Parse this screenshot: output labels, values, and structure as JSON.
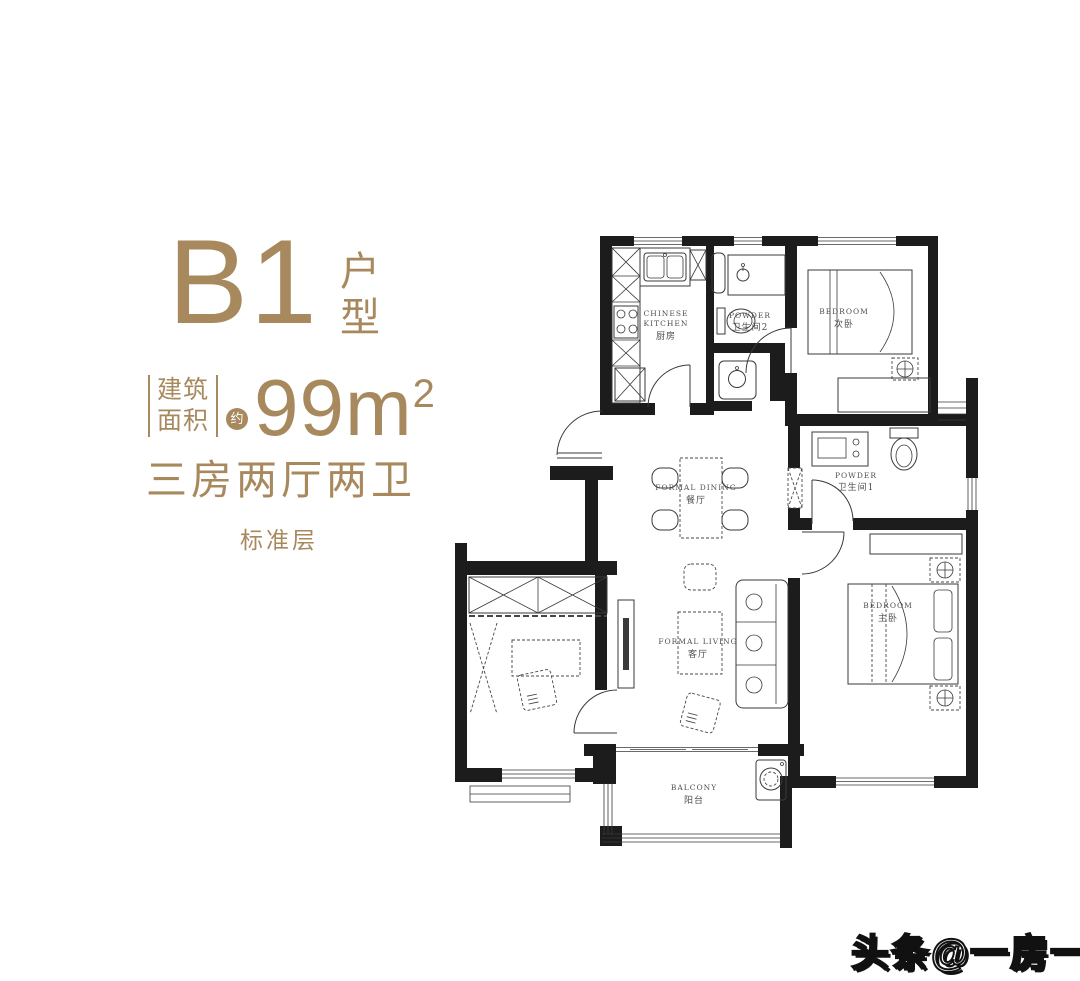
{
  "page": {
    "background": "#ffffff"
  },
  "colors": {
    "accent": "#a8895e",
    "wall": "#1c1c1c",
    "line": "#3a3a3a",
    "label": "#4f4f4f",
    "watermark_fill": "#ffffff",
    "watermark_outline": "#111111"
  },
  "title": {
    "code": "B1",
    "type_label": "户型"
  },
  "area": {
    "prefix_line1": "建筑",
    "prefix_line2": "面积",
    "approx_badge": "约",
    "value": "99",
    "unit": "m",
    "exponent": "2"
  },
  "layout_desc": "三房两厅两卫",
  "floor_label": "标准层",
  "watermark": "头条@一房一万",
  "plan": {
    "rooms": {
      "kitchen": {
        "en1": "CHINESE",
        "en2": "KITCHEN",
        "zh": "厨房"
      },
      "powder2": {
        "en": "POWDER",
        "zh": "卫生间2"
      },
      "bedroom2": {
        "en": "BEDROOM",
        "zh": "次卧"
      },
      "dining": {
        "en": "FORMAL DINING",
        "zh": "餐厅"
      },
      "powder1": {
        "en": "POWDER",
        "zh": "卫生间1"
      },
      "living": {
        "en": "FORMAL LIVING",
        "zh": "客厅"
      },
      "master": {
        "en": "BEDROOM",
        "zh": "主卧"
      },
      "balcony": {
        "en": "BALCONY",
        "zh": "阳台"
      }
    }
  }
}
